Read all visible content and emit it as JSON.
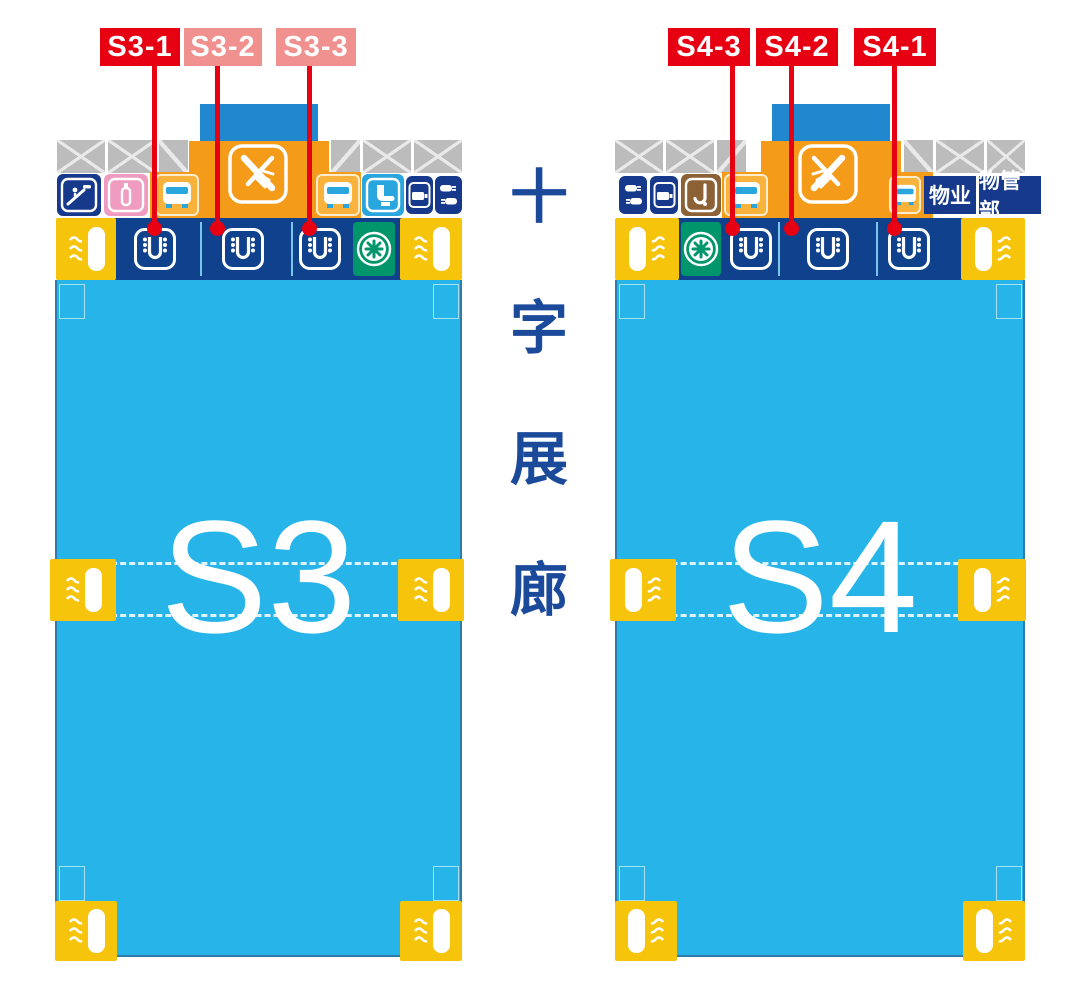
{
  "title": "S3 S4 exhibition halls map",
  "callouts": {
    "s3": [
      {
        "label": "S3-1"
      },
      {
        "label": "S3-2"
      },
      {
        "label": "S3-3"
      }
    ],
    "s4": [
      {
        "label": "S4-3"
      },
      {
        "label": "S4-2"
      },
      {
        "label": "S4-1"
      }
    ]
  },
  "corridor": {
    "text": "十字展廊",
    "chars": [
      "十",
      "字",
      "展",
      "廊"
    ]
  },
  "halls": [
    {
      "name": "S3"
    },
    {
      "name": "S4"
    }
  ],
  "property": {
    "wuye": "物业",
    "wuguanbu": "物管部"
  },
  "icons": [
    "escalator-icon",
    "nursing-room-icon",
    "shuttle-bus-icon",
    "restaurant-utensils-icon",
    "toilet-icon",
    "camera-icon",
    "charging-plugs-icon",
    "hook-icon",
    "gate-icon",
    "ventilation-fan-icon",
    "air-outlet-waves-icon",
    "truss-stairs-block",
    "ramp-block"
  ],
  "colors": {
    "hall_cyan": "#27b4e8",
    "strip_blue": "#0f418c",
    "yellow": "#f6c40a",
    "orange": "#f49c19",
    "cap_blue": "#2187cf",
    "red": "#e60012",
    "pink_label": "#f0908f",
    "dark_icon_blue": "#16398c",
    "pink_icon": "#f09cc0",
    "light_blue_icon": "#29a6dd",
    "green": "#00956b",
    "brown": "#8d6136",
    "gray": "#bcbcbc",
    "corridor_text": "#1b4a9b"
  }
}
